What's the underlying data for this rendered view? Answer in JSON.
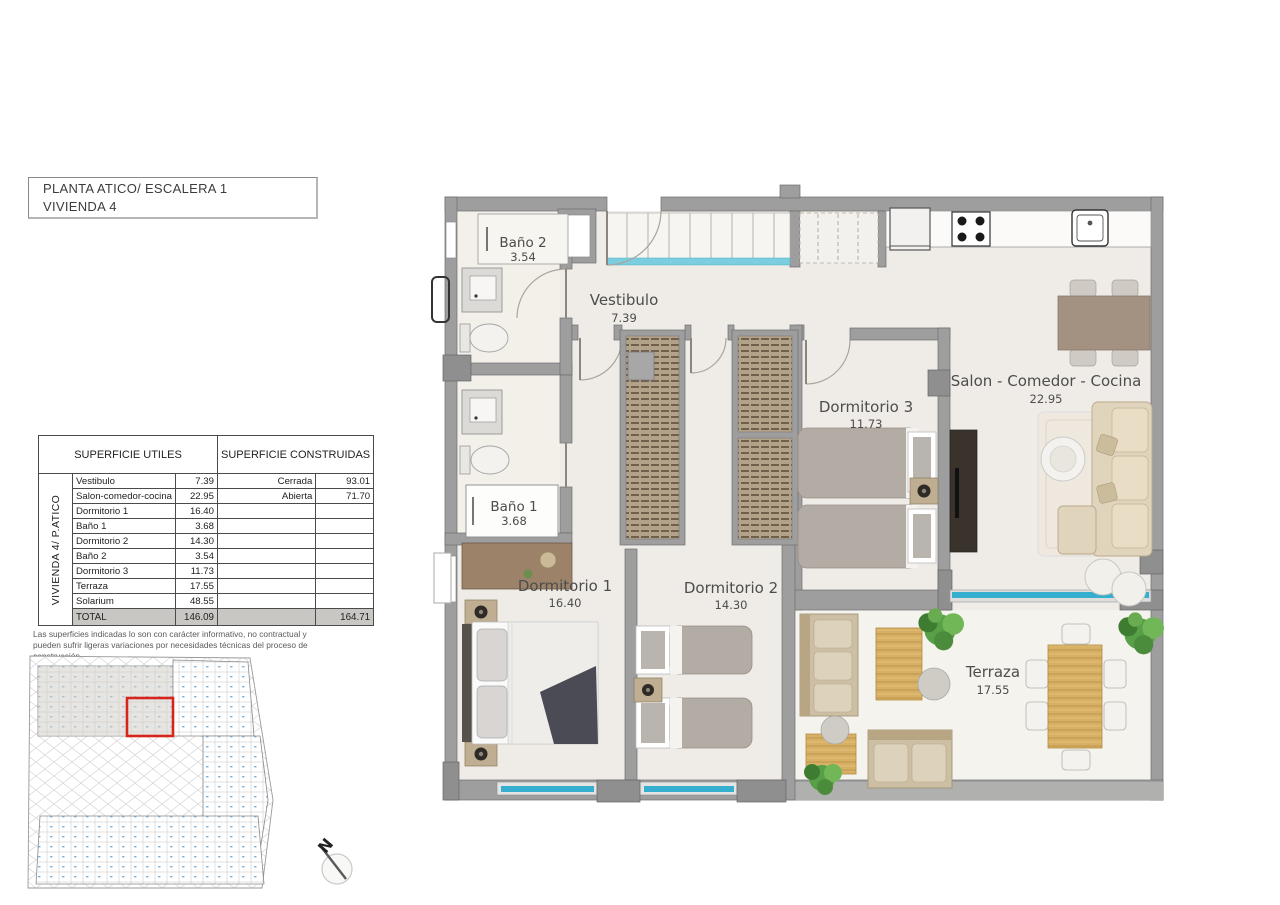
{
  "header": {
    "line1": "PLANTA ATICO/ ESCALERA 1",
    "line2": "VIVIENDA 4"
  },
  "surface_table": {
    "side_label": "VIVIENDA 4/ P.ATICO",
    "utiles_header": "SUPERFICIE UTILES",
    "construidas_header": "SUPERFICIE CONSTRUIDAS",
    "rows": [
      {
        "name": "Vestibulo",
        "value": "7.39"
      },
      {
        "name": "Salon-comedor-cocina",
        "value": "22.95"
      },
      {
        "name": "Dormitorio 1",
        "value": "16.40"
      },
      {
        "name": "Baño 1",
        "value": "3.68"
      },
      {
        "name": "Dormitorio 2",
        "value": "14.30"
      },
      {
        "name": "Baño 2",
        "value": "3.54"
      },
      {
        "name": "Dormitorio 3",
        "value": "11.73"
      },
      {
        "name": "Terraza",
        "value": "17.55"
      },
      {
        "name": "Solarium",
        "value": "48.55"
      }
    ],
    "construidas": [
      {
        "label": "Cerrada",
        "value": "93.01"
      },
      {
        "label": "Abierta",
        "value": "71.70"
      }
    ],
    "total": {
      "label": "TOTAL",
      "utiles": "146.09",
      "construidas": "164.71"
    }
  },
  "disclaimer": "Las superficies indicadas lo son con carácter informativo, no contractual y pueden sufrir ligeras variaciones por necesidades técnicas del proceso de construcción.",
  "compass": {
    "label": "N"
  },
  "floorplan": {
    "rooms": {
      "bano2": {
        "name": "Baño 2",
        "area": "3.54"
      },
      "vestibulo": {
        "name": "Vestibulo",
        "area": "7.39"
      },
      "bano1": {
        "name": "Baño 1",
        "area": "3.68"
      },
      "dormitorio1": {
        "name": "Dormitorio 1",
        "area": "16.40"
      },
      "dormitorio2": {
        "name": "Dormitorio 2",
        "area": "14.30"
      },
      "dormitorio3": {
        "name": "Dormitorio 3",
        "area": "11.73"
      },
      "salon": {
        "name": "Salon - Comedor - Cocina",
        "area": "22.95"
      },
      "terraza": {
        "name": "Terraza",
        "area": "17.55"
      }
    }
  },
  "colors": {
    "wall": "#9e9e9e",
    "window_glass": "#35aed0",
    "highlight_red": "#d6251c",
    "wood": "#d8b065",
    "plant_green": "#57a047",
    "floor": "#efece7"
  }
}
